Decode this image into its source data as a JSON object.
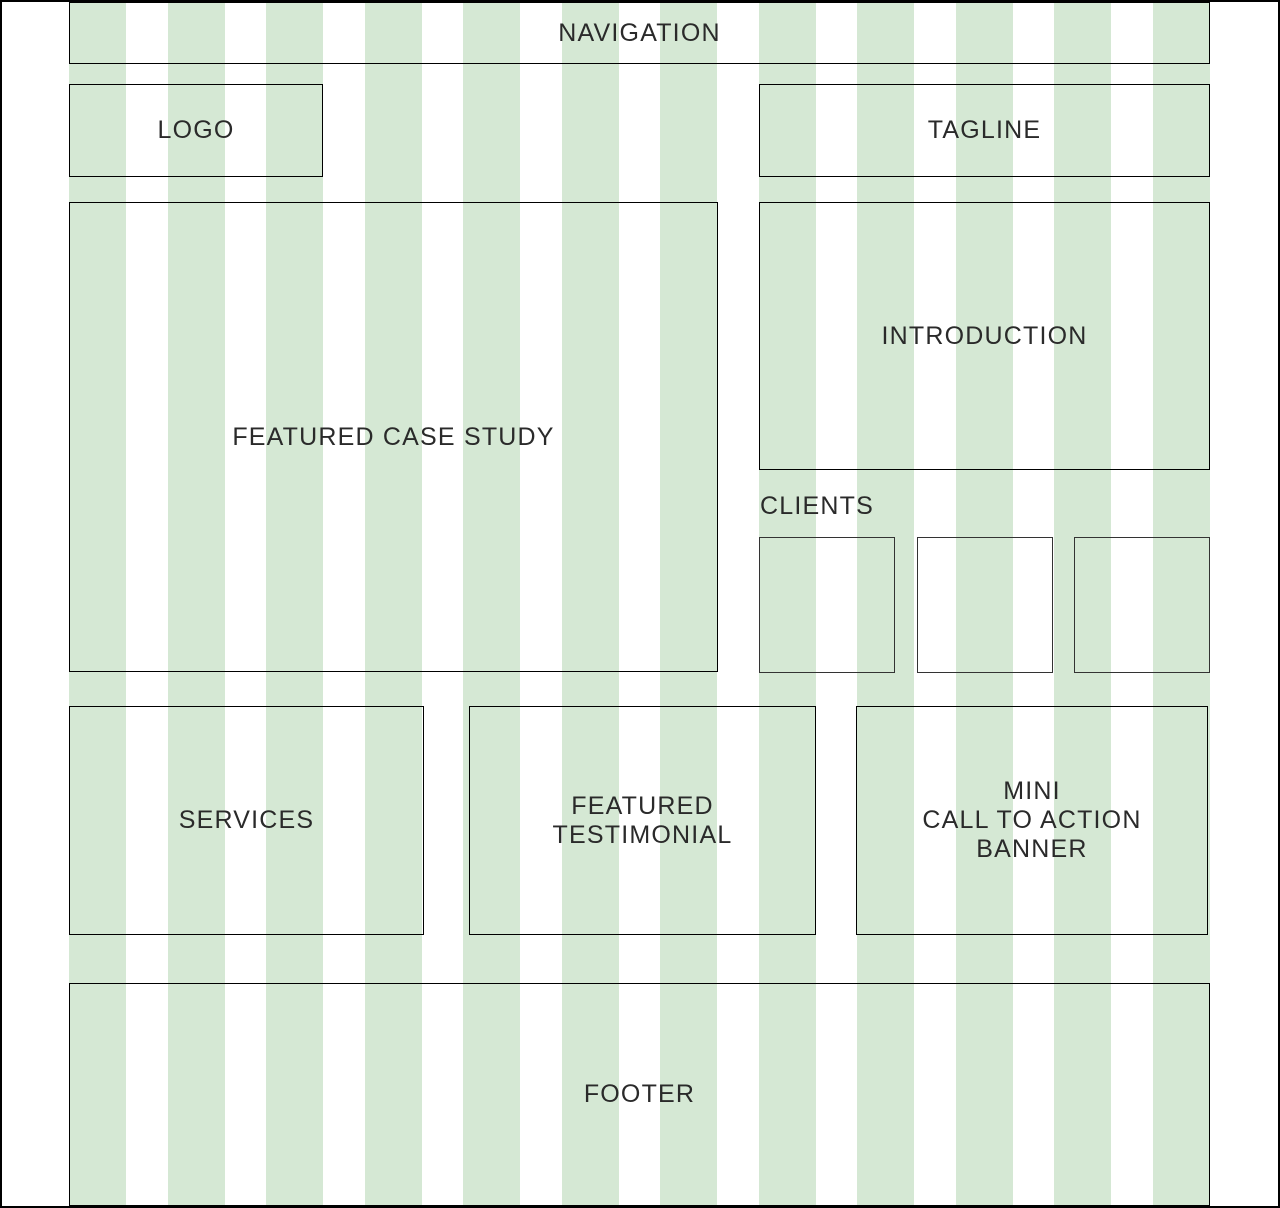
{
  "page": {
    "background_color": "#ffffff",
    "border_color": "#000000",
    "text_color": "#2a2a2a"
  },
  "grid": {
    "columns": 12,
    "stripe_color": "#d5e8d4"
  },
  "sections": {
    "navigation": {
      "label": "NAVIGATION"
    },
    "logo": {
      "label": "LOGO"
    },
    "tagline": {
      "label": "TAGLINE"
    },
    "featured_case_study": {
      "label": "FEATURED CASE STUDY"
    },
    "introduction": {
      "label": "INTRODUCTION"
    },
    "clients": {
      "heading": "CLIENTS",
      "placeholder_count": 3
    },
    "services": {
      "label": "SERVICES"
    },
    "featured_testimonial": {
      "label": "FEATURED\nTESTIMONIAL"
    },
    "mini_cta": {
      "label": "MINI\nCALL TO ACTION\nBANNER"
    },
    "footer": {
      "label": "FOOTER"
    }
  }
}
